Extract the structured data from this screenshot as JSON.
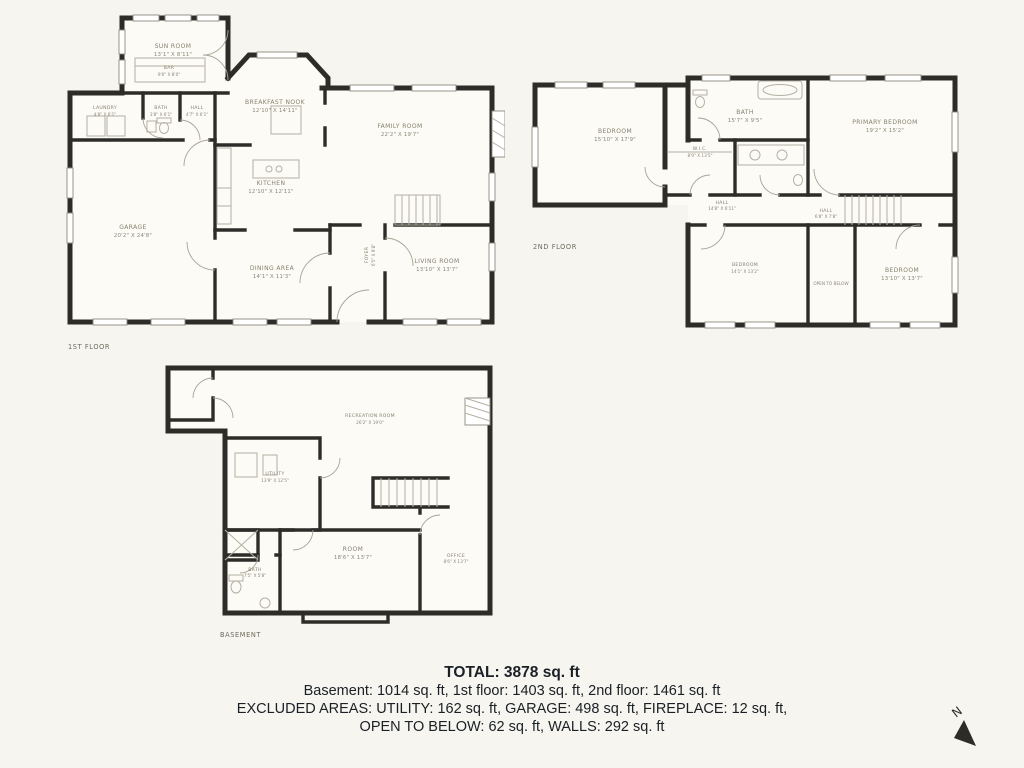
{
  "page": {
    "background_color": "#f6f5ef"
  },
  "summary": {
    "total": "TOTAL: 3878 sq. ft",
    "floors_line": "Basement: 1014 sq. ft, 1st floor: 1403 sq. ft, 2nd floor: 1461 sq. ft",
    "excluded_line1": "EXCLUDED AREAS: UTILITY: 162 sq. ft, GARAGE: 498 sq. ft, FIREPLACE: 12 sq. ft,",
    "excluded_line2": "OPEN TO BELOW: 62 sq. ft, WALLS: 292 sq. ft"
  },
  "compass": {
    "label": "N"
  },
  "floors": {
    "first": {
      "title": "1ST FLOOR",
      "rooms": {
        "sunroom": {
          "name": "SUN ROOM",
          "dims": "13'1\" X 8'11\""
        },
        "bar": {
          "name": "BAR",
          "dims": "9'0\" X 8'0\""
        },
        "laundry": {
          "name": "LAUNDRY",
          "dims": "4'8\" X 6'1\""
        },
        "bath": {
          "name": "BATH",
          "dims": "3'8\" X 6'1\""
        },
        "hall": {
          "name": "HALL",
          "dims": "4'7\" X 6'1\""
        },
        "breakfast": {
          "name": "BREAKFAST NOOK",
          "dims": "12'10\" X 14'11\""
        },
        "family": {
          "name": "FAMILY ROOM",
          "dims": "22'2\" X 19'7\""
        },
        "kitchen": {
          "name": "KITCHEN",
          "dims": "12'10\" X 12'11\""
        },
        "garage": {
          "name": "GARAGE",
          "dims": "20'2\" X 24'8\""
        },
        "dining": {
          "name": "DINING AREA",
          "dims": "14'1\" X 11'3\""
        },
        "foyer": {
          "name": "FOYER",
          "dims": "6'5\" X 9'8\""
        },
        "living": {
          "name": "LIVING ROOM",
          "dims": "13'10\" X 13'7\""
        }
      }
    },
    "second": {
      "title": "2ND FLOOR",
      "rooms": {
        "bedroom_tl": {
          "name": "BEDROOM",
          "dims": "15'10\" X 17'9\""
        },
        "bath": {
          "name": "BATH",
          "dims": "15'7\" X 9'5\""
        },
        "wic": {
          "name": "W.I.C.",
          "dims": "8'9\" X 13'5\""
        },
        "primary": {
          "name": "PRIMARY BEDROOM",
          "dims": "19'2\" X 15'2\""
        },
        "hall_left": {
          "name": "HALL",
          "dims": "14'8\" X 6'11\""
        },
        "hall_right": {
          "name": "HALL",
          "dims": "6'8\" X 7'8\""
        },
        "bedroom_bl": {
          "name": "BEDROOM",
          "dims": "14'1\" X 13'2\""
        },
        "open_below": {
          "name": "OPEN TO BELOW"
        },
        "bedroom_br": {
          "name": "BEDROOM",
          "dims": "13'10\" X 13'7\""
        }
      }
    },
    "basement": {
      "title": "BASEMENT",
      "rooms": {
        "recreation": {
          "name": "RECREATION ROOM",
          "dims": "26'2\" X 19'0\""
        },
        "utility": {
          "name": "UTILITY",
          "dims": "13'9\" X 12'5\""
        },
        "room": {
          "name": "ROOM",
          "dims": "18'6\" X 13'7\""
        },
        "office": {
          "name": "OFFICE",
          "dims": "8'6\" X 13'7\""
        },
        "bath": {
          "name": "BATH",
          "dims": "7'5\" X 5'8\""
        }
      }
    }
  }
}
